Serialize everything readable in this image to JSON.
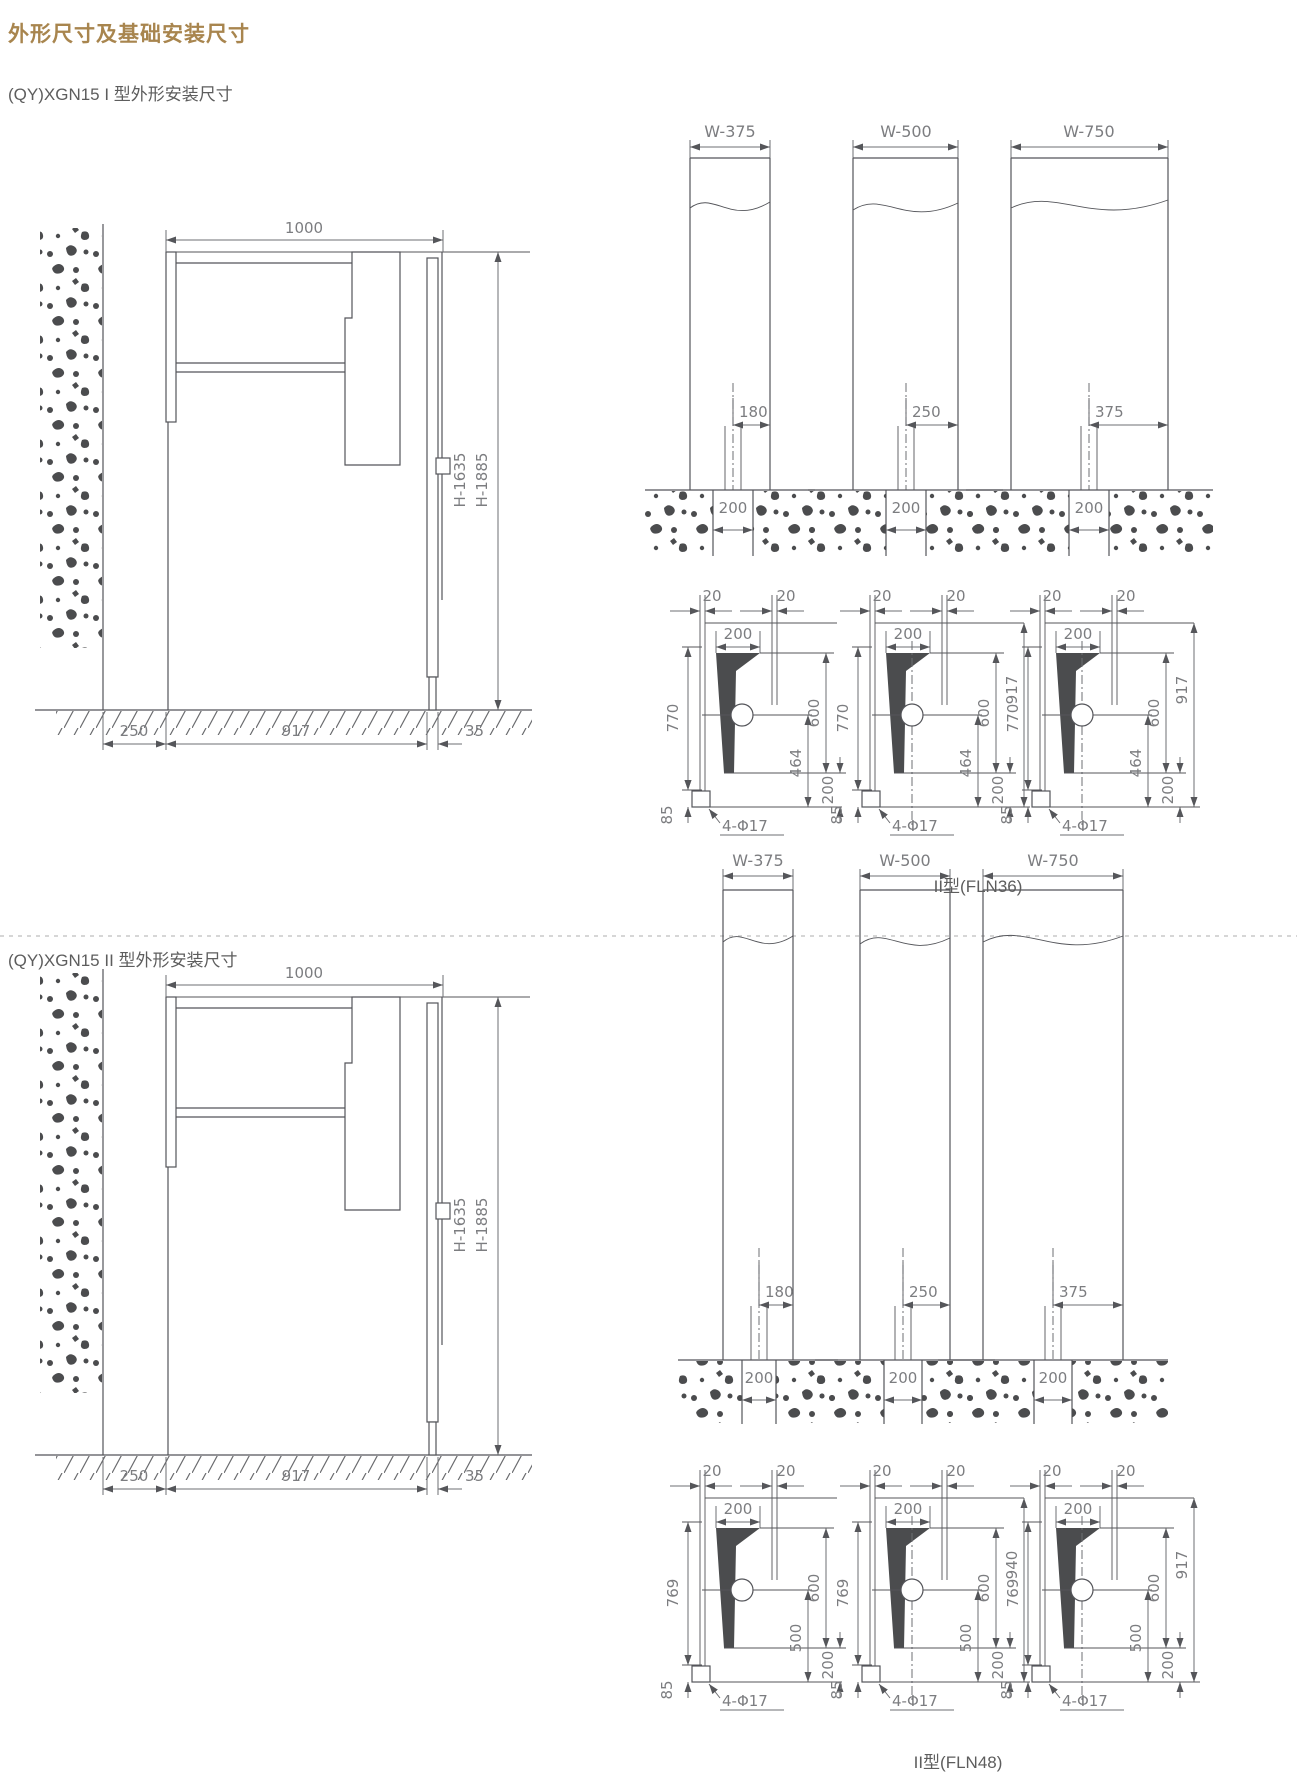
{
  "page": {
    "title": "外形尺寸及基础安装尺寸",
    "accent_color": "#a8854e",
    "line_color": "#54555a"
  },
  "s1": {
    "subtitle": "(QY)XGN15 I 型外形安装尺寸",
    "caption": "II型(FLN36)",
    "side": {
      "top": "1000",
      "h1": "H-1635",
      "h2": "H-1885",
      "b1": "250",
      "b2": "917",
      "b3": "35"
    },
    "elev": [
      {
        "label": "W-375",
        "offset": "180",
        "trench": "200"
      },
      {
        "label": "W-500",
        "offset": "250",
        "trench": "200"
      },
      {
        "label": "W-750",
        "offset": "375",
        "trench": "200"
      }
    ],
    "plans": [
      {
        "g1": "20",
        "g2": "20",
        "top": "200",
        "left": "770",
        "right1": "600",
        "right2": "464",
        "right3": "200",
        "base": "85",
        "holes": "4-Φ17"
      },
      {
        "g1": "20",
        "g2": "20",
        "top": "200",
        "left": "770",
        "right1": "600",
        "right2": "464",
        "right3": "200",
        "base": "85",
        "holes": "4-Φ17",
        "outer": "917"
      },
      {
        "g1": "20",
        "g2": "20",
        "top": "200",
        "left": "770",
        "right1": "600",
        "right2": "464",
        "right3": "200",
        "base": "85",
        "holes": "4-Φ17",
        "outer": "917"
      }
    ]
  },
  "s2": {
    "subtitle": "(QY)XGN15 II 型外形安装尺寸",
    "caption": "II型(FLN48)",
    "side": {
      "top": "1000",
      "h1": "H-1635",
      "h2": "H-1885",
      "b1": "250",
      "b2": "917",
      "b3": "35"
    },
    "elev": [
      {
        "label": "W-375",
        "offset": "180",
        "trench": "200"
      },
      {
        "label": "W-500",
        "offset": "250",
        "trench": "200"
      },
      {
        "label": "W-750",
        "offset": "375",
        "trench": "200"
      }
    ],
    "plans": [
      {
        "g1": "20",
        "g2": "20",
        "top": "200",
        "left": "769",
        "right1": "600",
        "right2": "500",
        "right3": "200",
        "base": "85",
        "holes": "4-Φ17"
      },
      {
        "g1": "20",
        "g2": "20",
        "top": "200",
        "left": "769",
        "right1": "600",
        "right2": "500",
        "right3": "200",
        "base": "85",
        "holes": "4-Φ17",
        "outer": "940"
      },
      {
        "g1": "20",
        "g2": "20",
        "top": "200",
        "left": "769",
        "right1": "600",
        "right2": "500",
        "right3": "200",
        "base": "85",
        "holes": "4-Φ17",
        "outer": "917"
      }
    ]
  }
}
